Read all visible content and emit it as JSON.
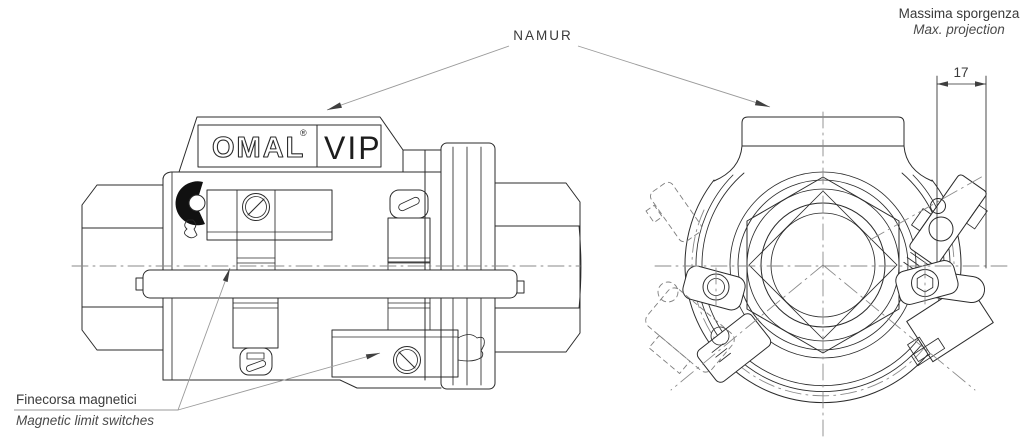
{
  "drawing": {
    "background": "#ffffff",
    "line_color": "#2b2b2b",
    "centerline_color": "#8a8a8a",
    "leader_color": "#9a9a9a",
    "arrow_color": "#3f3f3f",
    "indicator_fill": "#111111"
  },
  "labels": {
    "namur": "NAMUR",
    "max_projection_it": "Massima sporgenza",
    "max_projection_en": "Max. projection",
    "projection_dimension_mm": "17",
    "limit_switches_it": "Finecorsa magnetici",
    "limit_switches_en": "Magnetic limit switches"
  },
  "nameplate": {
    "brand": "OMAL",
    "trademark": "®",
    "series": "VIP"
  }
}
